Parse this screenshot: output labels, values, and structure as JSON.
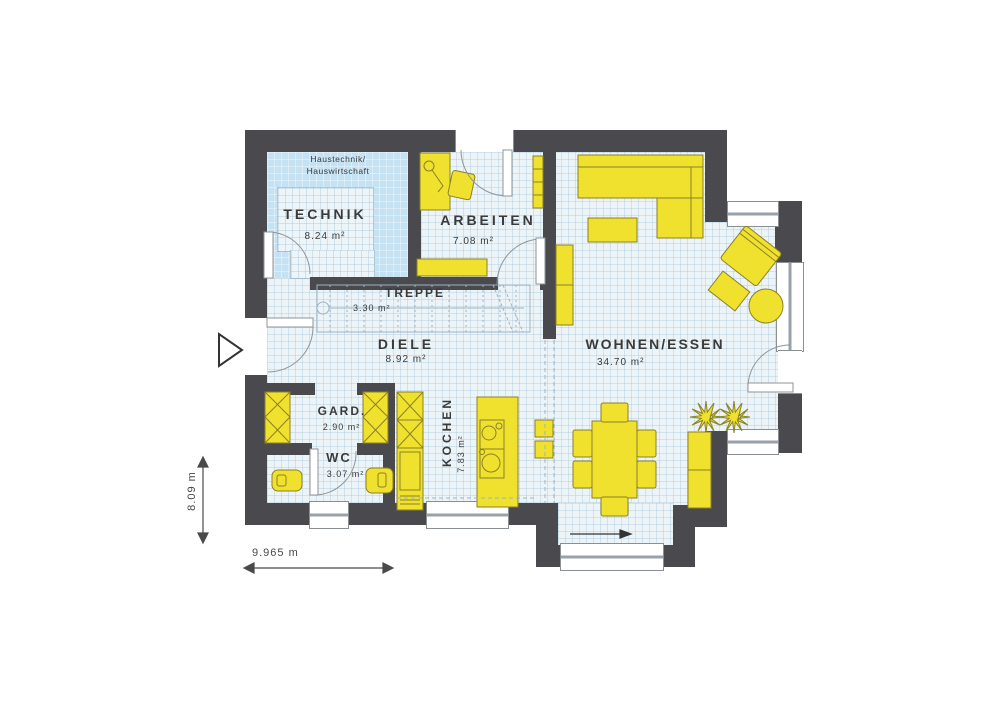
{
  "plan": {
    "title": "ground-floor-plan",
    "note": {
      "line1": "Haustechnik/",
      "line2": "Hauswirtschaft"
    },
    "rooms": [
      {
        "id": "technik",
        "name": "TECHNIK",
        "area": "8.24 m²"
      },
      {
        "id": "arbeiten",
        "name": "ARBEITEN",
        "area": "7.08 m²"
      },
      {
        "id": "treppe",
        "name": "TREPPE",
        "area": "3.30 m²"
      },
      {
        "id": "diele",
        "name": "DIELE",
        "area": "8.92 m²"
      },
      {
        "id": "wohnen-essen",
        "name": "WOHNEN/ESSEN",
        "area": "34.70 m²"
      },
      {
        "id": "gard",
        "name": "GARD.",
        "area": "2.90 m²"
      },
      {
        "id": "wc",
        "name": "WC",
        "area": "3.07 m²"
      },
      {
        "id": "kochen",
        "name": "KOCHEN",
        "area": "7.83 m²"
      }
    ],
    "dims": {
      "height": "8.09 m",
      "width": "9.965 m"
    },
    "colors": {
      "wall": "#4a4a4e",
      "floor": "#edf4f8",
      "technik_zone": "#c4e2f2",
      "furniture": "#f1e12f",
      "furniture_outline": "#8a8126",
      "text": "#3a3a3a"
    }
  }
}
